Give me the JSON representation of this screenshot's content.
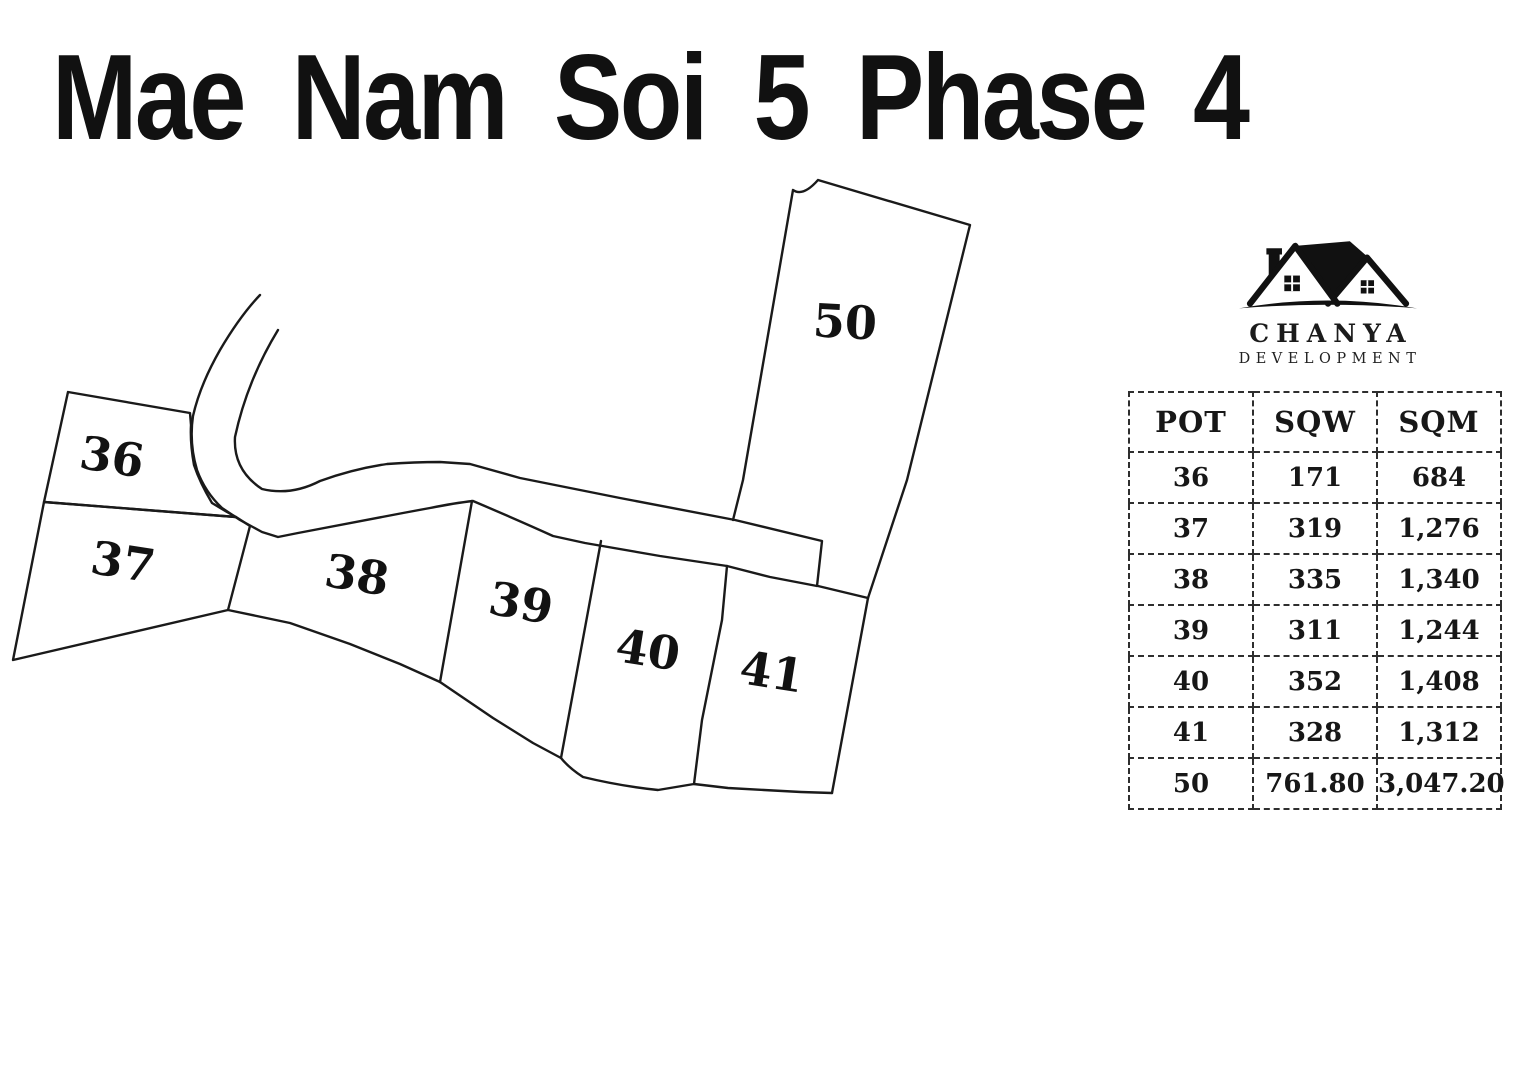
{
  "title": "Mae Nam Soi 5 Phase 4",
  "logo": {
    "icon": "houses-icon",
    "brand": "CHANYA",
    "subtitle": "DEVELOPMENT"
  },
  "map": {
    "plots": [
      {
        "label": "36"
      },
      {
        "label": "37"
      },
      {
        "label": "38"
      },
      {
        "label": "39"
      },
      {
        "label": "40"
      },
      {
        "label": "41"
      },
      {
        "label": "50"
      }
    ]
  },
  "table": {
    "headers": [
      "POT",
      "SQW",
      "SQM"
    ],
    "rows": [
      {
        "pot": "36",
        "sqw": "171",
        "sqm": "684"
      },
      {
        "pot": "37",
        "sqw": "319",
        "sqm": "1,276"
      },
      {
        "pot": "38",
        "sqw": "335",
        "sqm": "1,340"
      },
      {
        "pot": "39",
        "sqw": "311",
        "sqm": "1,244"
      },
      {
        "pot": "40",
        "sqw": "352",
        "sqm": "1,408"
      },
      {
        "pot": "41",
        "sqw": "328",
        "sqm": "1,312"
      },
      {
        "pot": "50",
        "sqw": "761.80",
        "sqm": "3,047.20"
      }
    ]
  },
  "colors": {
    "ink": "#1a1a1a",
    "background": "#ffffff"
  }
}
